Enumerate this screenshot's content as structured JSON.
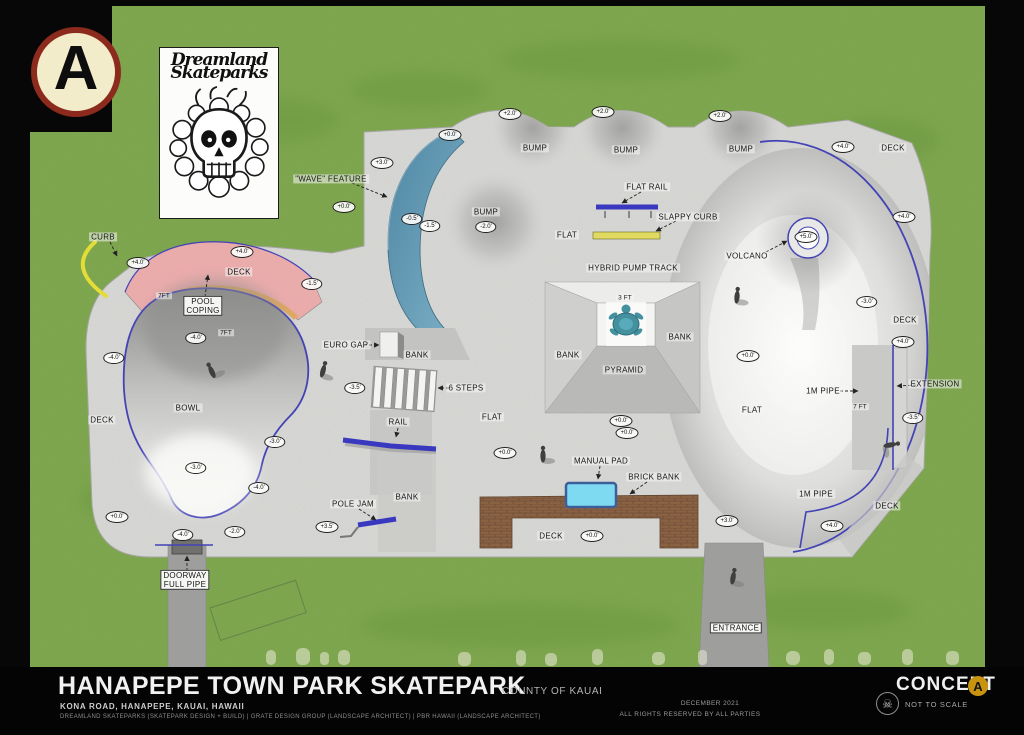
{
  "badge": {
    "letter": "A"
  },
  "logo": {
    "line1": "Dreamland",
    "line2": "Skateparks"
  },
  "plan": {
    "colors": {
      "grass": "#7da64d",
      "concrete": "#dadad8",
      "coping": "#4343b6",
      "rail_blue": "#3939c0",
      "curb_yellow": "#e3dc39",
      "coping_orange": "#e0a85e",
      "deck_pink": "#eaabab",
      "manual_pad": "#7edaf0",
      "turtle": "#43909f",
      "path_grey": "#9e9e9c",
      "brick": "#8a6243"
    },
    "labels": [
      {
        "text": "\"WAVE\" FEATURE",
        "x": 331,
        "y": 179
      },
      {
        "text": "BUMP",
        "x": 535,
        "y": 148
      },
      {
        "text": "BUMP",
        "x": 626,
        "y": 150
      },
      {
        "text": "BUMP",
        "x": 741,
        "y": 149
      },
      {
        "text": "BUMP",
        "x": 486,
        "y": 212
      },
      {
        "text": "FLAT RAIL",
        "x": 647,
        "y": 187
      },
      {
        "text": "SLAPPY CURB",
        "x": 688,
        "y": 217
      },
      {
        "text": "FLAT",
        "x": 567,
        "y": 235
      },
      {
        "text": "HYBRID PUMP TRACK",
        "x": 633,
        "y": 268
      },
      {
        "text": "VOLCANO",
        "x": 747,
        "y": 256
      },
      {
        "text": "DECK",
        "x": 893,
        "y": 148
      },
      {
        "text": "DECK",
        "x": 905,
        "y": 320
      },
      {
        "text": "CURB",
        "x": 103,
        "y": 237
      },
      {
        "text": "DECK",
        "x": 239,
        "y": 272
      },
      {
        "text": "POOL\nCOPING",
        "x": 203,
        "y": 306,
        "boxed": true
      },
      {
        "text": "7FT",
        "x": 164,
        "y": 296,
        "small": true
      },
      {
        "text": "7FT",
        "x": 226,
        "y": 333,
        "small": true
      },
      {
        "text": "BOWL",
        "x": 188,
        "y": 408
      },
      {
        "text": "DECK",
        "x": 102,
        "y": 420
      },
      {
        "text": "EURO GAP",
        "x": 346,
        "y": 345
      },
      {
        "text": "BANK",
        "x": 417,
        "y": 355
      },
      {
        "text": "6 STEPS",
        "x": 466,
        "y": 388
      },
      {
        "text": "FLAT",
        "x": 492,
        "y": 417
      },
      {
        "text": "RAIL",
        "x": 398,
        "y": 422
      },
      {
        "text": "BANK",
        "x": 407,
        "y": 497
      },
      {
        "text": "POLE JAM",
        "x": 353,
        "y": 504
      },
      {
        "text": "MANUAL PAD",
        "x": 601,
        "y": 461
      },
      {
        "text": "BRICK BANK",
        "x": 654,
        "y": 477
      },
      {
        "text": "DECK",
        "x": 551,
        "y": 536
      },
      {
        "text": "FLAT",
        "x": 752,
        "y": 410
      },
      {
        "text": "1M PIPE",
        "x": 823,
        "y": 391
      },
      {
        "text": "EXTENSION",
        "x": 935,
        "y": 384
      },
      {
        "text": "7 FT",
        "x": 860,
        "y": 407,
        "small": true
      },
      {
        "text": "3 FT",
        "x": 625,
        "y": 298,
        "small": true
      },
      {
        "text": "BANK",
        "x": 568,
        "y": 355
      },
      {
        "text": "BANK",
        "x": 680,
        "y": 337
      },
      {
        "text": "PYRAMID",
        "x": 624,
        "y": 370
      },
      {
        "text": "1M PIPE",
        "x": 816,
        "y": 494
      },
      {
        "text": "DECK",
        "x": 887,
        "y": 506
      },
      {
        "text": "DOORWAY\nFULL PIPE",
        "x": 185,
        "y": 580,
        "boxed": true
      },
      {
        "text": "ENTRANCE",
        "x": 736,
        "y": 628,
        "boxed": true
      }
    ],
    "leaders": [
      {
        "for": "wave-feature",
        "x1": 352,
        "y1": 183,
        "x2": 387,
        "y2": 197
      },
      {
        "for": "flat-rail",
        "x1": 641,
        "y1": 192,
        "x2": 622,
        "y2": 203
      },
      {
        "for": "slappy-curb",
        "x1": 676,
        "y1": 221,
        "x2": 656,
        "y2": 231
      },
      {
        "for": "volcano",
        "x1": 766,
        "y1": 252,
        "x2": 787,
        "y2": 241
      },
      {
        "for": "curb",
        "x1": 110,
        "y1": 242,
        "x2": 117,
        "y2": 256
      },
      {
        "for": "pool-coping",
        "x1": 205,
        "y1": 297,
        "x2": 208,
        "y2": 275
      },
      {
        "for": "six-steps",
        "x1": 449,
        "y1": 388,
        "x2": 438,
        "y2": 388
      },
      {
        "for": "rail",
        "x1": 398,
        "y1": 428,
        "x2": 396,
        "y2": 437
      },
      {
        "for": "pole-jam",
        "x1": 359,
        "y1": 509,
        "x2": 376,
        "y2": 520
      },
      {
        "for": "manual-pad",
        "x1": 600,
        "y1": 466,
        "x2": 598,
        "y2": 479
      },
      {
        "for": "brick-bank",
        "x1": 647,
        "y1": 482,
        "x2": 630,
        "y2": 494
      },
      {
        "for": "one-m-pipe",
        "x1": 840,
        "y1": 391,
        "x2": 858,
        "y2": 391
      },
      {
        "for": "extension",
        "x1": 916,
        "y1": 385,
        "x2": 897,
        "y2": 386
      },
      {
        "for": "euro-gap",
        "x1": 364,
        "y1": 345,
        "x2": 379,
        "y2": 345
      },
      {
        "for": "doorway-full-pipe",
        "x1": 187,
        "y1": 571,
        "x2": 187,
        "y2": 556
      }
    ],
    "elevation_markers": [
      {
        "x": 510,
        "y": 114,
        "value": "+2.0'"
      },
      {
        "x": 603,
        "y": 112,
        "value": "+2.0'"
      },
      {
        "x": 720,
        "y": 116,
        "value": "+2.0'"
      },
      {
        "x": 450,
        "y": 135,
        "value": "+0.0'"
      },
      {
        "x": 382,
        "y": 163,
        "value": "+3.0'"
      },
      {
        "x": 344,
        "y": 207,
        "value": "+0.0'"
      },
      {
        "x": 412,
        "y": 219,
        "value": "-0.5'"
      },
      {
        "x": 430,
        "y": 226,
        "value": "-1.5'"
      },
      {
        "x": 486,
        "y": 227,
        "value": "-2.0'"
      },
      {
        "x": 843,
        "y": 147,
        "value": "+4.0'"
      },
      {
        "x": 806,
        "y": 237,
        "value": "+5.0'"
      },
      {
        "x": 904,
        "y": 217,
        "value": "+4.0'"
      },
      {
        "x": 867,
        "y": 302,
        "value": "-3.0'"
      },
      {
        "x": 138,
        "y": 263,
        "value": "+4.0'"
      },
      {
        "x": 242,
        "y": 252,
        "value": "+4.0'"
      },
      {
        "x": 312,
        "y": 284,
        "value": "-1.5'"
      },
      {
        "x": 196,
        "y": 338,
        "value": "-4.0'"
      },
      {
        "x": 114,
        "y": 358,
        "value": "-4.0'"
      },
      {
        "x": 275,
        "y": 442,
        "value": "-3.0'"
      },
      {
        "x": 196,
        "y": 468,
        "value": "-3.0'"
      },
      {
        "x": 259,
        "y": 488,
        "value": "-4.0'"
      },
      {
        "x": 117,
        "y": 517,
        "value": "+0.0'"
      },
      {
        "x": 183,
        "y": 535,
        "value": "-4.0'"
      },
      {
        "x": 235,
        "y": 532,
        "value": "-2.0'"
      },
      {
        "x": 327,
        "y": 527,
        "value": "+3.5'"
      },
      {
        "x": 355,
        "y": 388,
        "value": "-3.5'"
      },
      {
        "x": 505,
        "y": 453,
        "value": "+0.0'"
      },
      {
        "x": 627,
        "y": 433,
        "value": "+0.0'"
      },
      {
        "x": 621,
        "y": 421,
        "value": "+0.0'"
      },
      {
        "x": 748,
        "y": 356,
        "value": "+0.0'"
      },
      {
        "x": 903,
        "y": 342,
        "value": "+4.0'"
      },
      {
        "x": 913,
        "y": 418,
        "value": "-3.5'"
      },
      {
        "x": 832,
        "y": 526,
        "value": "+4.0'"
      },
      {
        "x": 727,
        "y": 521,
        "value": "+3.0'"
      },
      {
        "x": 592,
        "y": 536,
        "value": "+0.0'"
      }
    ]
  },
  "titleblock": {
    "title": "HANAPEPE TOWN PARK SKATEPARK",
    "jurisdiction": "COUNTY OF KAUAI",
    "address": "KONA ROAD, HANAPEPE, KAUAI, HAWAII",
    "credits": "DREAMLAND SKATEPARKS (SKATEPARK DESIGN + BUILD)  |  GRATE DESIGN GROUP (LANDSCAPE ARCHITECT)  |  PBR HAWAII (LANDSCAPE ARCHITECT)",
    "date": "DECEMBER 2021",
    "rights": "ALL RIGHTS RESERVED BY ALL PARTIES",
    "concept_label": "CONCEPT",
    "concept_letter": "A",
    "scale_note": "NOT TO SCALE"
  }
}
